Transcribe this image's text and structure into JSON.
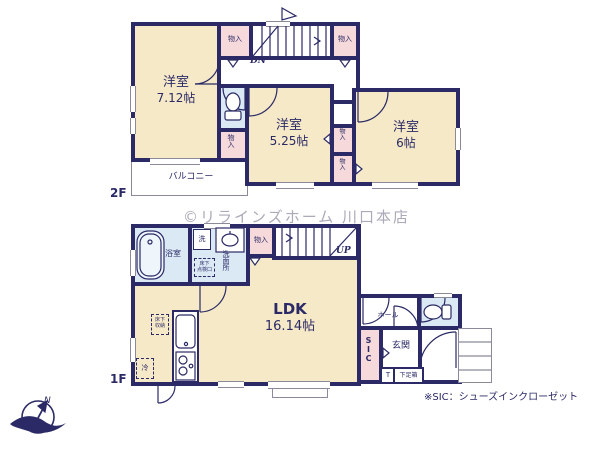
{
  "watermark": "©リラインズホーム 川口本店",
  "note": "※SIC：シューズインクローゼット",
  "compass": {
    "north": "N"
  },
  "labels": {
    "closet": "物入"
  },
  "floor2": {
    "label": "2F",
    "room1": {
      "name": "洋室",
      "size": "7.12帖"
    },
    "room2": {
      "name": "洋室",
      "size": "5.25帖"
    },
    "room3": {
      "name": "洋室",
      "size": "6帖"
    },
    "balcony": "バルコニー",
    "stairs_down": "DN"
  },
  "floor1": {
    "label": "1F",
    "ldk": {
      "name": "LDK",
      "size": "16.14帖"
    },
    "bath": "浴室",
    "washroom": "洗面所",
    "washer": "洗",
    "inspection_line1": "床下",
    "inspection_line2": "点検口",
    "floor_storage_line1": "床下",
    "floor_storage_line2": "収納",
    "fridge": "冷",
    "stairs_up": "UP",
    "hall": "ホール",
    "sic": "SIC",
    "entrance": "玄関",
    "shoebox_t": "T",
    "shoebox": "下足箱"
  },
  "colors": {
    "wall": "#2b2a66",
    "room": "#f6e9c8",
    "closet": "#f6d9da",
    "wet_area": "#dbe9f5"
  }
}
